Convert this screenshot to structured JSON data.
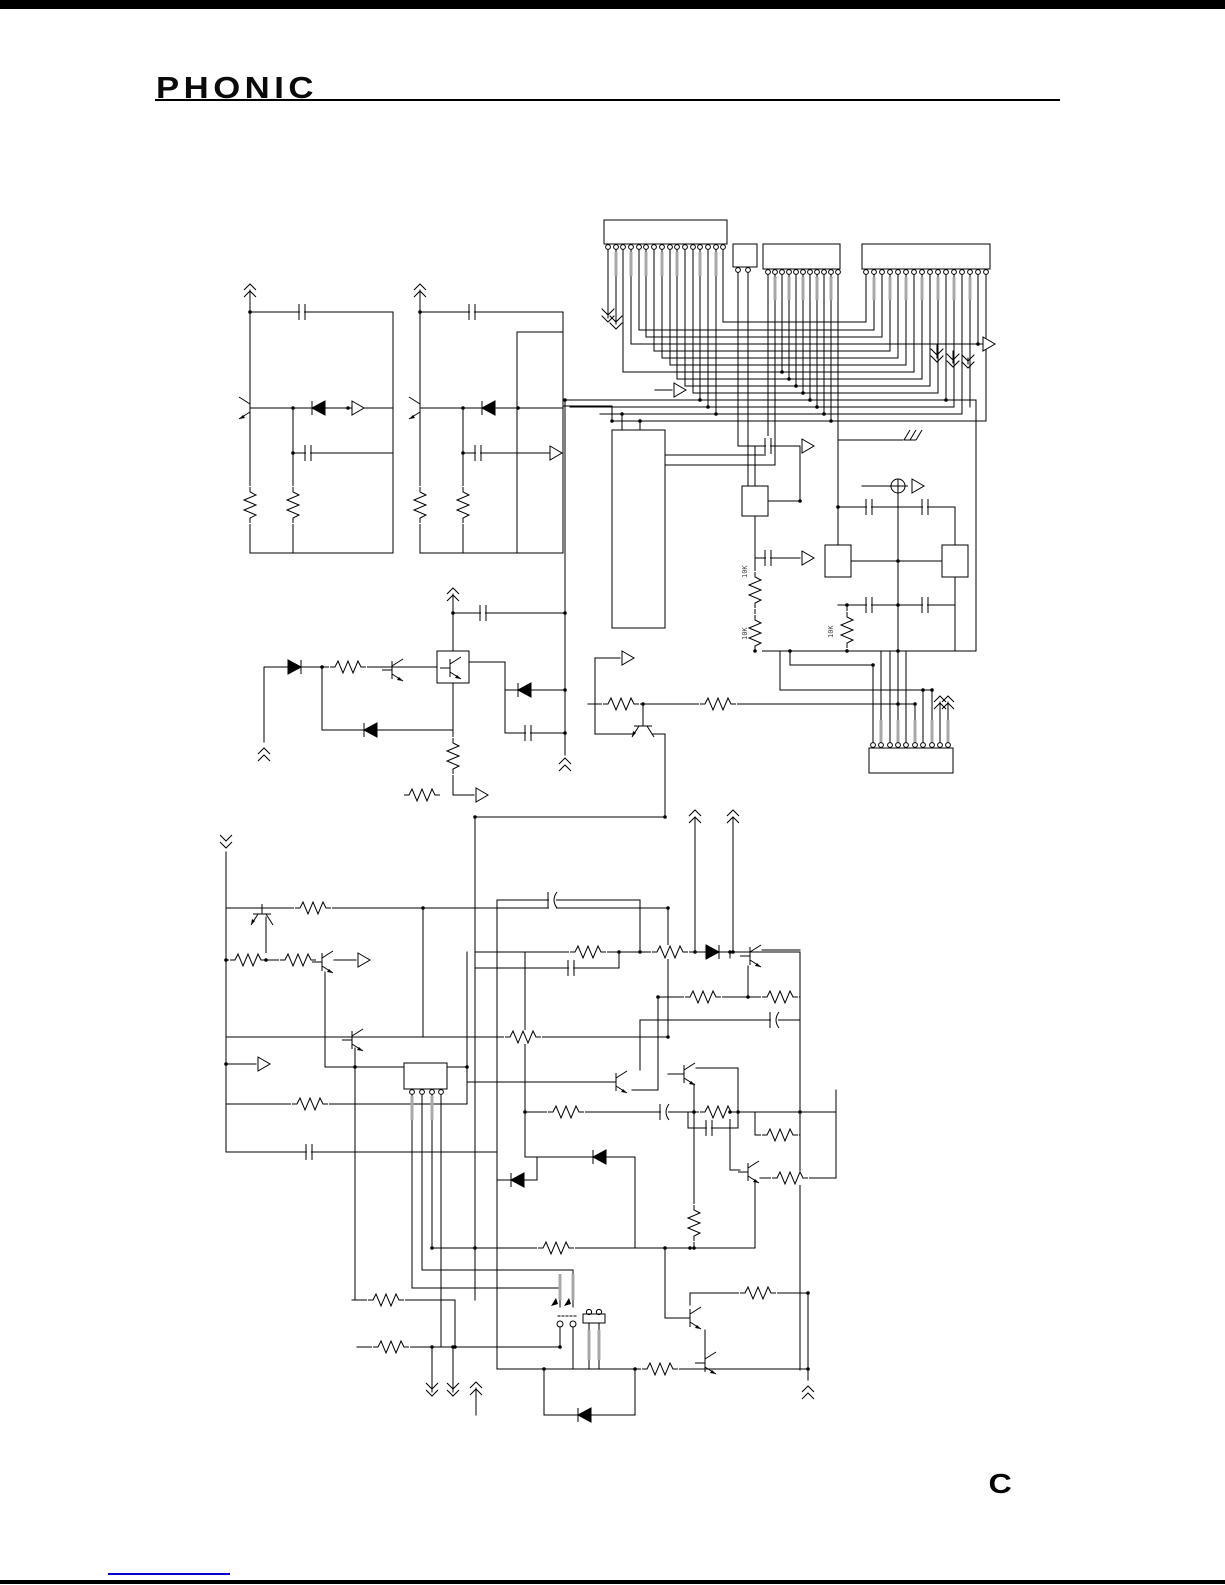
{
  "header": {
    "logo": "PHONIC",
    "rule_color": "#000000"
  },
  "footer": {
    "mark": "C",
    "link_underline_color": "#0000cc",
    "rule_color": "#000000"
  },
  "schematic": {
    "ink_color": "#000000",
    "lead_color": "#a8a8a8",
    "labels": [
      {
        "text": "10K"
      },
      {
        "text": "10K"
      },
      {
        "text": "10K"
      }
    ],
    "connectors": {
      "top_left": {
        "pins": 16
      },
      "top_small": {
        "pins": 2
      },
      "top_mid": {
        "pins": 11
      },
      "top_right": {
        "pins": 16
      },
      "bottom": {
        "pins": 10
      }
    }
  }
}
